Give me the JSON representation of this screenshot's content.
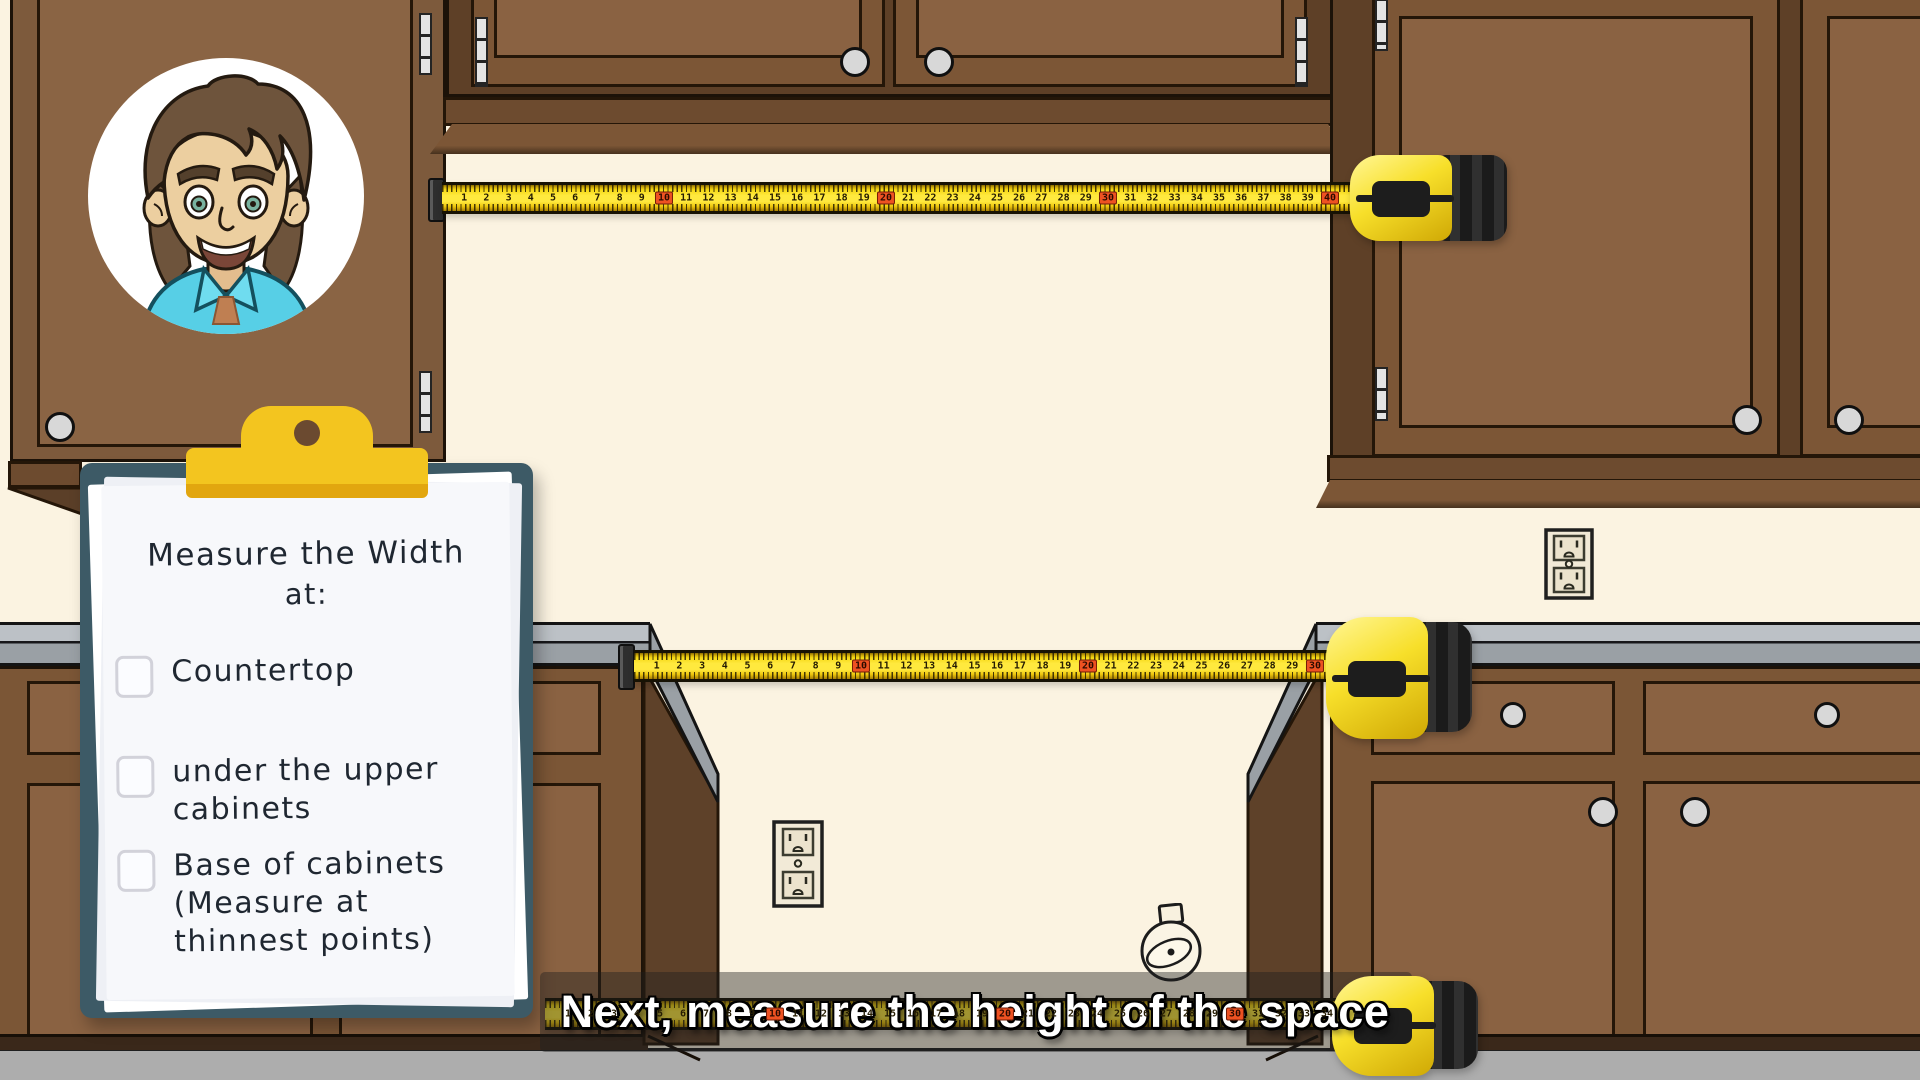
{
  "checklist": {
    "title_line1": "Measure the Width",
    "title_line2": "at:",
    "items": [
      {
        "label_lines": [
          "Countertop"
        ],
        "checked": false
      },
      {
        "label_lines": [
          "under the upper",
          "cabinets"
        ],
        "checked": false
      },
      {
        "label_lines": [
          "Base of cabinets",
          "(Measure at",
          "thinnest points)"
        ],
        "checked": false
      }
    ]
  },
  "caption": {
    "text": "Next, measure the height of the space"
  },
  "tapes": {
    "red_every": 10,
    "top": {
      "from": 1,
      "to": 40,
      "px_per_unit": 22.2
    },
    "middle": {
      "from": 1,
      "to": 30,
      "px_per_unit": 22.7
    },
    "bottom": {
      "from": 1,
      "to": 34,
      "px_per_unit": 23.0
    }
  },
  "icons": {
    "avatar": "cartoon-man-avatar",
    "outlet": "power-outlet",
    "sketch": "tape-measure-sketch",
    "tape_body": "tape-measure-body"
  },
  "colors": {
    "wall": "#fbf3e1",
    "cabinet": "#7c5636",
    "cabinet_panel": "#8a6242",
    "cabinet_dark": "#5e4027",
    "counter_gray": "#9aa0a5",
    "floor_gray": "#adadad",
    "tape_yellow": "#ffe93e",
    "tape_marker_red": "#ee5222",
    "clipboard_teal": "#3d5a66",
    "clip_gold": "#f3c51f",
    "paper": "#f7f8fb",
    "caption_text": "#ffffff"
  }
}
